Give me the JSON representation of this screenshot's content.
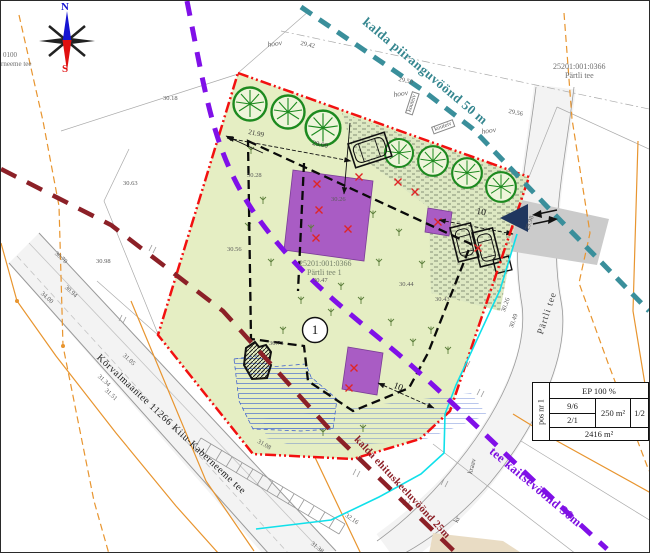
{
  "compass": {
    "north": "N",
    "south": "S"
  },
  "zones": {
    "shore_limit": "kalda piiranguvöönd 50 m",
    "road_protection": "tee kaitsevöönd 30m",
    "building_exclusion": "kalda ehituskeeluvöönd 25m"
  },
  "roads": {
    "main": "Kõrvalmaantee 11266 Kiiu-Kaberneeme tee",
    "side": "Pärtli tee"
  },
  "cadastre": {
    "site_code": "25201:001:0366",
    "site_name": "Pärtli tee 1",
    "neighbor_code": "25201:001:0366",
    "neighbor_name": "Pärtli tee",
    "edge_code": "0100",
    "edge_name": "rneeme tee"
  },
  "plot": {
    "number": "1"
  },
  "title_table": {
    "pos": "pos nr 1",
    "usage": "EP 100 %",
    "ratio_a": "9/6",
    "ratio_b": "2/1",
    "building_area": "250 m²",
    "storeys": "1/2",
    "plot_area": "2416 m²"
  },
  "dimensions": {
    "front": "21.99",
    "side": "29.00",
    "setback_east": "10",
    "setback_south": "10"
  },
  "yard_labels": {
    "a": "hoov",
    "b": "hoov",
    "c": "hoov"
  },
  "boxed_labels": {
    "a": "kouteiv",
    "b": "kouteiv"
  },
  "misc_labels": {
    "kr": "kr",
    "ditch": "kraav"
  },
  "elevations": [
    {
      "v": "30.18"
    },
    {
      "v": "29.42"
    },
    {
      "v": "29.50"
    },
    {
      "v": "29.56"
    },
    {
      "v": "30.63"
    },
    {
      "v": "30.98"
    },
    {
      "v": "30.70"
    },
    {
      "v": "34.00"
    },
    {
      "v": "30.94"
    },
    {
      "v": "30.28"
    },
    {
      "v": "30.26"
    },
    {
      "v": "30.56"
    },
    {
      "v": "30.47"
    },
    {
      "v": "30.44"
    },
    {
      "v": "30.43"
    },
    {
      "v": "30.73"
    },
    {
      "v": "31.05"
    },
    {
      "v": "31.34"
    },
    {
      "v": "31.51"
    },
    {
      "v": "31.08"
    },
    {
      "v": "32.16"
    },
    {
      "v": "31.38"
    },
    {
      "v": "29.98"
    },
    {
      "v": "30.26"
    },
    {
      "v": "30.49"
    }
  ]
}
